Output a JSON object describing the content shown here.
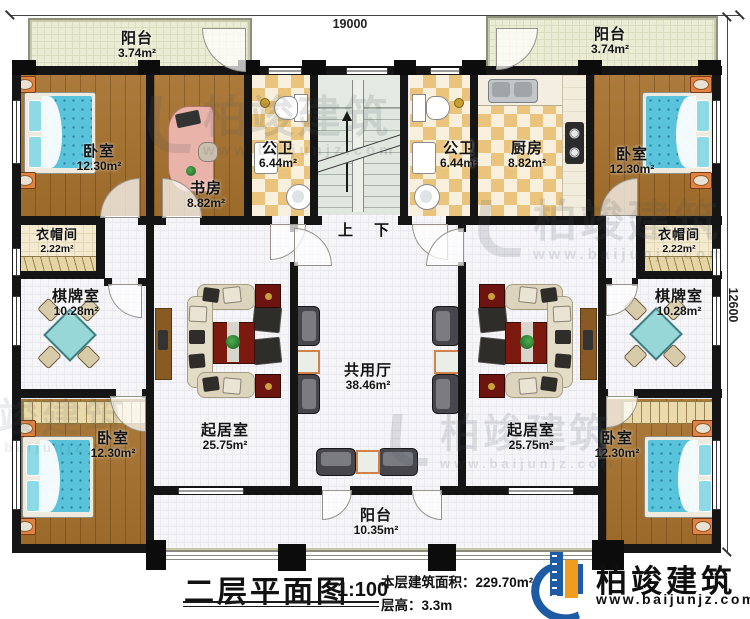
{
  "plan": {
    "dimensions": {
      "width_mm": "19000",
      "depth_mm": "12600"
    },
    "stair_labels": {
      "up": "上",
      "down": "下"
    },
    "rooms": {
      "balcony_tl": {
        "name": "阳台",
        "area": "3.74m²"
      },
      "balcony_tr": {
        "name": "阳台",
        "area": "3.74m²"
      },
      "bedroom_tl": {
        "name": "卧室",
        "area": "12.30m²"
      },
      "study": {
        "name": "书房",
        "area": "8.82m²"
      },
      "bath_l": {
        "name": "公卫",
        "area": "6.44m²"
      },
      "bath_r": {
        "name": "公卫",
        "area": "6.44m²"
      },
      "kitchen": {
        "name": "厨房",
        "area": "8.82m²"
      },
      "bedroom_tr": {
        "name": "卧室",
        "area": "12.30m²"
      },
      "cloak_l": {
        "name": "衣帽间",
        "area": "2.22m²"
      },
      "cloak_r": {
        "name": "衣帽间",
        "area": "2.22m²"
      },
      "chess_l": {
        "name": "棋牌室",
        "area": "10.28m²"
      },
      "chess_r": {
        "name": "棋牌室",
        "area": "10.28m²"
      },
      "living_l": {
        "name": "起居室",
        "area": "25.75m²"
      },
      "living_r": {
        "name": "起居室",
        "area": "25.75m²"
      },
      "hall": {
        "name": "共用厅",
        "area": "38.46m²"
      },
      "bedroom_bl": {
        "name": "卧室",
        "area": "12.30m²"
      },
      "bedroom_br": {
        "name": "卧室",
        "area": "12.30m²"
      },
      "balcony_b": {
        "name": "阳台",
        "area": "10.35m²"
      }
    }
  },
  "titleblock": {
    "title": "二层平面图",
    "scale": "1:100",
    "area_label": "本层建筑面积：",
    "area_value": "229.70m²",
    "floor_height_label": "层高：",
    "floor_height_value": "3.3m"
  },
  "brand": {
    "name": "柏竣建筑",
    "website": "www.baijunjz.com"
  },
  "watermark": {
    "text": "柏竣建筑",
    "website": "www.baijunjz.com"
  },
  "colors": {
    "wall": "#151515",
    "wood_floor": "#a5702c",
    "tile": "#eac47c",
    "bed_teal": "#58c3da",
    "brand_blue": "#1d5ca4",
    "brand_orange": "#f29c1f"
  }
}
